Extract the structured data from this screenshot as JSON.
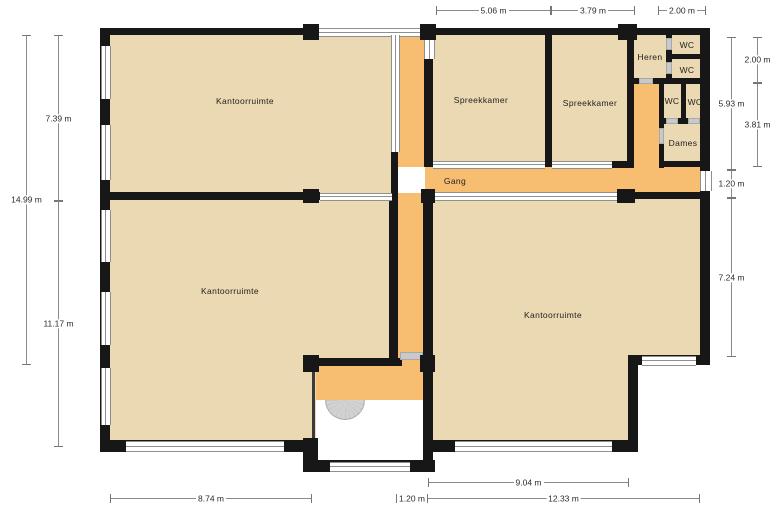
{
  "plan_title": "Office floor plan (Dutch labels)",
  "colors": {
    "room": "#ebd9b3",
    "hall": "#f7be71",
    "wall": "#171717",
    "glass": "#8f8f8f",
    "door": "#c9c9c9",
    "dimline": "#8a8a8a",
    "text": "#1f1f1f"
  },
  "rooms": [
    {
      "id": "kantoorruimte-top-left",
      "label": "Kantoorruimte"
    },
    {
      "id": "spreekkamer-left",
      "label": "Spreekkamer"
    },
    {
      "id": "spreekkamer-right",
      "label": "Spreekkamer"
    },
    {
      "id": "heren",
      "label": "Heren"
    },
    {
      "id": "wc-1",
      "label": "WC"
    },
    {
      "id": "wc-2",
      "label": "WC"
    },
    {
      "id": "wc-3",
      "label": "WC"
    },
    {
      "id": "wc-4",
      "label": "WC"
    },
    {
      "id": "dames",
      "label": "Dames"
    },
    {
      "id": "gang",
      "label": "Gang"
    },
    {
      "id": "kantoorruimte-bottom-left",
      "label": "Kantoorruimte"
    },
    {
      "id": "kantoorruimte-bottom-right",
      "label": "Kantoorruimte"
    }
  ],
  "dims": {
    "top": [
      {
        "value": "5.06 m"
      },
      {
        "value": "3.79 m"
      },
      {
        "value": "2.00 m"
      }
    ],
    "bottom": [
      {
        "value": "9.04 m"
      },
      {
        "value": "8.74 m"
      },
      {
        "value": "1.20 m"
      },
      {
        "value": "12.33 m"
      }
    ],
    "left": [
      {
        "value": "7.39 m"
      },
      {
        "value": "14.99 m"
      },
      {
        "value": "11.17 m"
      }
    ],
    "right": [
      {
        "value": "2.00 m"
      },
      {
        "value": "5.93 m"
      },
      {
        "value": "3.81 m"
      },
      {
        "value": "1.20 m"
      },
      {
        "value": "7.24 m"
      }
    ]
  }
}
